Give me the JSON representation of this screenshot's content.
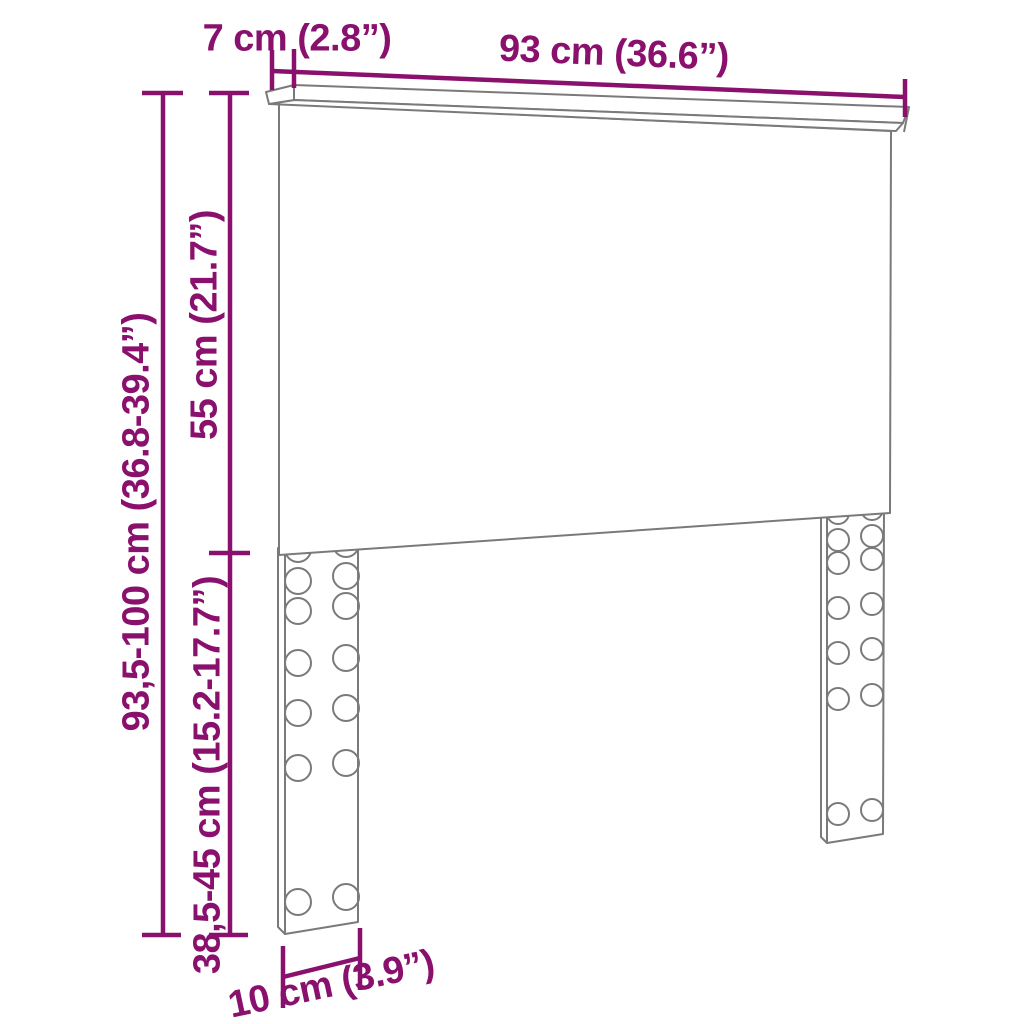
{
  "diagram": {
    "type": "furniture-dimension-diagram",
    "subject": "headboard with two slotted legs",
    "accent_color": "#8a106e",
    "line_color": "#7a7a7a",
    "background_color": "#ffffff",
    "labels": {
      "shelf_depth": "7 cm (2.8”)",
      "total_width": "93 cm (36.6”)",
      "panel_height": "55 cm (21.7”)",
      "overall_height": "93,5-100 cm (36.8-39.4”)",
      "leg_height": "38,5-45 cm (15.2-17.7”)",
      "foot_width": "10 cm (3.9”)"
    },
    "dimensions": [
      {
        "name": "shelf-depth",
        "cm": "7",
        "inch": "2.8",
        "orientation": "horizontal-top"
      },
      {
        "name": "total-width",
        "cm": "93",
        "inch": "36.6",
        "orientation": "horizontal-top"
      },
      {
        "name": "panel-height",
        "cm": "55",
        "inch": "21.7",
        "orientation": "vertical-left"
      },
      {
        "name": "overall-height",
        "cm": "93,5-100",
        "inch": "36.8-39.4",
        "orientation": "vertical-far-left"
      },
      {
        "name": "leg-height",
        "cm": "38,5-45",
        "inch": "15.2-17.7",
        "orientation": "vertical-left"
      },
      {
        "name": "foot-width",
        "cm": "10",
        "inch": "3.9",
        "orientation": "horizontal-bottom"
      }
    ]
  }
}
